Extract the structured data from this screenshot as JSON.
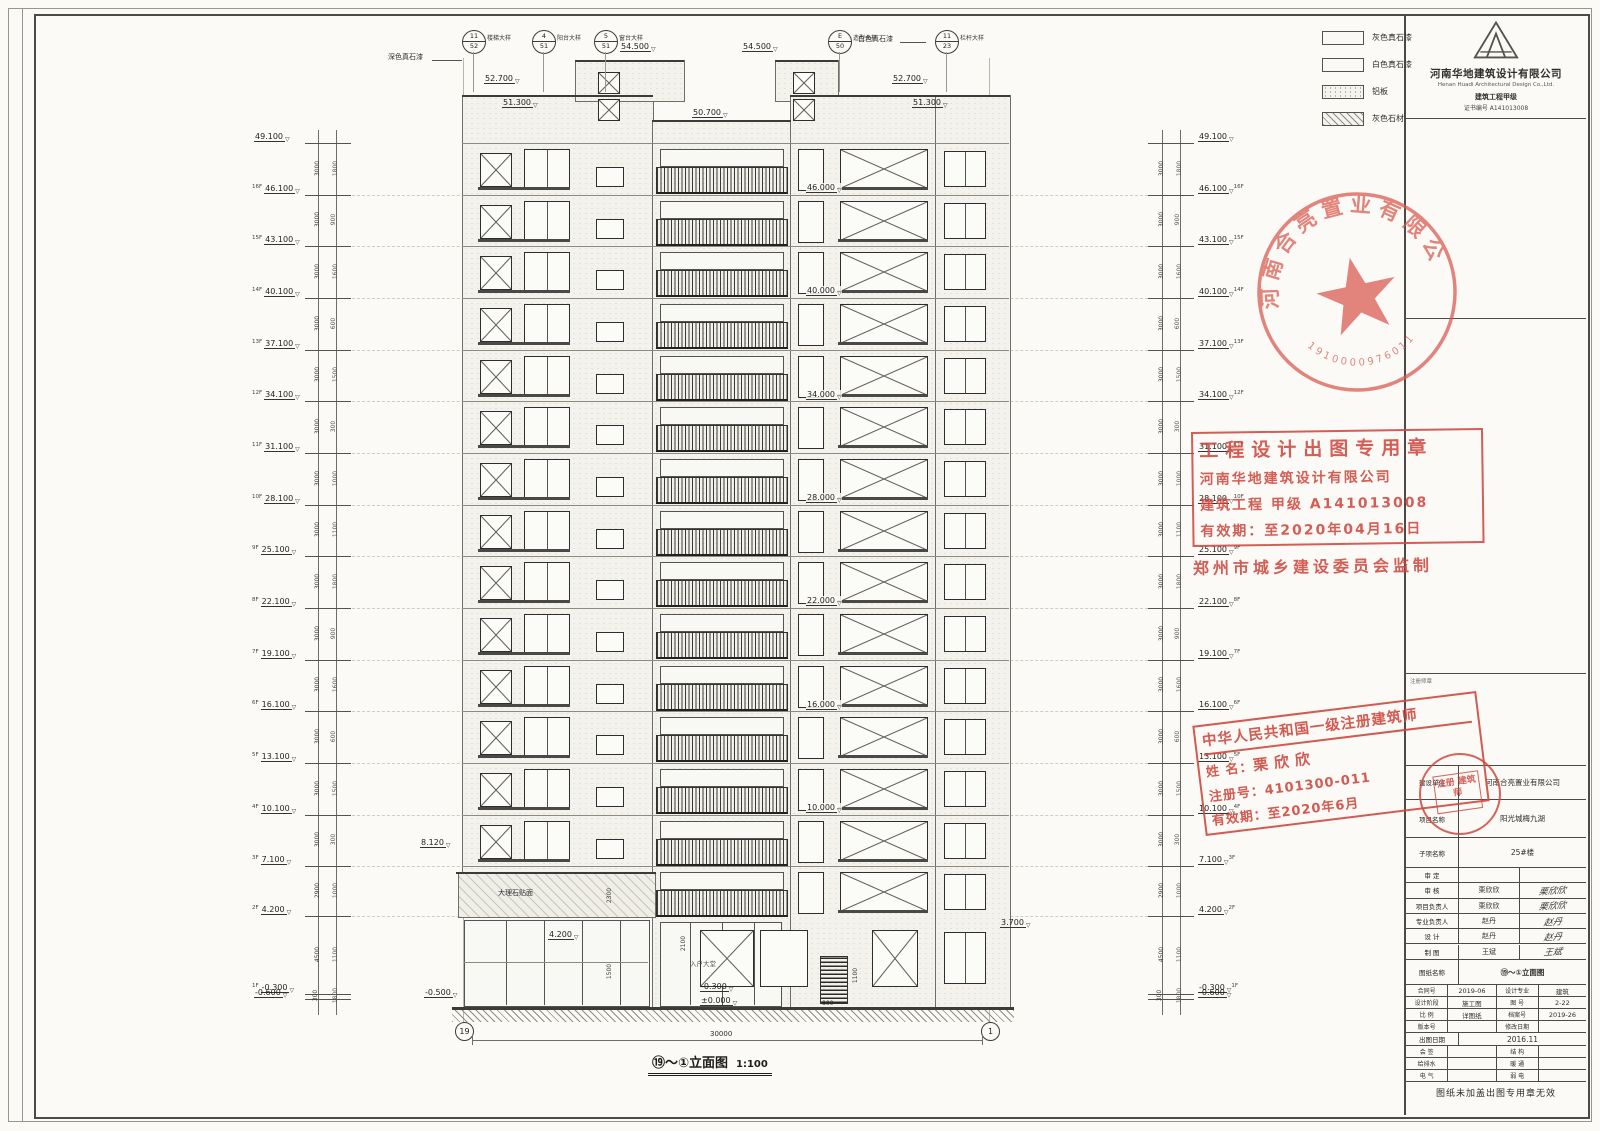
{
  "company": {
    "name": "河南华地建筑设计有限公司",
    "name_en": "Henan Huadi Architectural Design Co.,Ltd.",
    "grade": "建筑工程甲级",
    "cert_no": "证书编号 A141013008"
  },
  "legend": {
    "items": [
      {
        "name": "灰色真石漆",
        "pattern": "plain"
      },
      {
        "name": "白色真石漆",
        "pattern": "plain"
      },
      {
        "name": "铝板",
        "pattern": "dots"
      },
      {
        "name": "灰色石材",
        "pattern": "hatch"
      }
    ]
  },
  "elevation": {
    "caption": "⑲～①立面图",
    "scale": "1:100",
    "overall_dim": "30000",
    "axis_start": "19",
    "axis_end": "1",
    "floors": [
      {
        "tag": "",
        "level": "49.100"
      },
      {
        "tag": "16F",
        "level": "46.100"
      },
      {
        "tag": "15F",
        "level": "43.100"
      },
      {
        "tag": "14F",
        "level": "40.100"
      },
      {
        "tag": "13F",
        "level": "37.100"
      },
      {
        "tag": "12F",
        "level": "34.100"
      },
      {
        "tag": "11F",
        "level": "31.100"
      },
      {
        "tag": "10F",
        "level": "28.100"
      },
      {
        "tag": "9F",
        "level": "25.100"
      },
      {
        "tag": "8F",
        "level": "22.100"
      },
      {
        "tag": "7F",
        "level": "19.100"
      },
      {
        "tag": "6F",
        "level": "16.100"
      },
      {
        "tag": "5F",
        "level": "13.100"
      },
      {
        "tag": "4F",
        "level": "10.100"
      },
      {
        "tag": "3F",
        "level": "7.100"
      },
      {
        "tag": "2F",
        "level": "4.200"
      },
      {
        "tag": "1F",
        "level": "-0.300"
      },
      {
        "tag": "",
        "level": "-0.600"
      }
    ],
    "inner_dims": [
      "1100",
      "1800",
      "900",
      "1600",
      "600",
      "1500",
      "300",
      "1000"
    ],
    "stair_levels": [
      "46.000",
      "40.000",
      "34.000",
      "28.000",
      "22.000",
      "16.000",
      "10.000"
    ],
    "roof_marks": {
      "t54a": "54.500",
      "t54b": "54.500",
      "t527L": "52.700",
      "t513L": "51.300",
      "t507": "50.700",
      "t527R": "52.700",
      "t513R": "51.300"
    },
    "marks": {
      "m8120": "8.120",
      "m4200": "4.200",
      "m3700": "3.700",
      "m0500": "-0.500",
      "m0300": "-0.300",
      "m0000": "±0.000",
      "d2300": "2300",
      "d1500": "1500",
      "d800": "800",
      "d1100": "1100",
      "d2100": "2100"
    },
    "notes": {
      "left": "深色真石漆",
      "right": "白色真石漆",
      "podium": "大理石贴面",
      "lobby": "入户大堂"
    },
    "callouts": [
      {
        "num": "11",
        "den": "52",
        "label": "楼梯大样"
      },
      {
        "num": "4",
        "den": "51",
        "label": "阳台大样"
      },
      {
        "num": "5",
        "den": "51",
        "label": "窗台大样"
      },
      {
        "num": "E",
        "den": "50",
        "label": "造型大样"
      },
      {
        "num": "11",
        "den": "23",
        "label": "栏杆大样"
      }
    ]
  },
  "stamps": {
    "round_seal": {
      "company": "河南合亮置业有限公司",
      "number": "1910000976011"
    },
    "permit": {
      "title": "工程设计出图专用章",
      "company": "河南华地建筑设计有限公司",
      "grade": "建筑工程 甲级 A141013008",
      "valid": "有效期：至2020年04月16日",
      "issuer": "郑州市城乡建设委员会监制"
    },
    "architect": {
      "title": "中华人民共和国一级注册建筑师",
      "name_label": "姓 名：",
      "name": "栗欣欣",
      "reg_label": "注册号：",
      "reg": "4101300-011",
      "valid_label": "有效期：",
      "valid": "至2020年6月"
    },
    "project_seal": "注册 建筑师"
  },
  "titleblock": {
    "stamp_area_label": "注册师章",
    "client_label": "建设单位",
    "client": "河南合亮置业有限公司",
    "project_label": "项目名称",
    "project": "阳光城梅九湖",
    "sub_label": "子项名称",
    "sub": "25#楼",
    "sign_rows": [
      {
        "label": "审 定",
        "name": "",
        "sig": ""
      },
      {
        "label": "审 核",
        "name": "栗欣欣",
        "sig": "栗欣欣"
      },
      {
        "label": "项目负责人",
        "name": "栗欣欣",
        "sig": "栗欣欣"
      },
      {
        "label": "专业负责人",
        "name": "赵丹",
        "sig": "赵丹"
      },
      {
        "label": "设 计",
        "name": "赵丹",
        "sig": "赵丹"
      },
      {
        "label": "制 图",
        "name": "王斌",
        "sig": "王斌"
      }
    ],
    "dwg_label": "图纸名称",
    "dwg_name": "⑲～①立面图",
    "info_rows": [
      {
        "l1": "合同号",
        "v1": "2019-06",
        "l2": "设计专业",
        "v2": "建筑"
      },
      {
        "l1": "设计阶段",
        "v1": "施工图",
        "l2": "图 号",
        "v2": "2-22"
      },
      {
        "l1": "比 例",
        "v1": "详图纸",
        "l2": "档案号",
        "v2": "2019-26"
      },
      {
        "l1": "版本号",
        "v1": "",
        "l2": "修改日期",
        "v2": ""
      }
    ],
    "date_label": "出图日期",
    "date": "2016.11",
    "cosign": [
      {
        "l": "会 签",
        "r": "结 构"
      },
      {
        "l": "给排水",
        "r": "暖 通"
      },
      {
        "l": "电 气",
        "r": "弱 电"
      }
    ],
    "footer": "图纸未加盖出图专用章无效"
  }
}
